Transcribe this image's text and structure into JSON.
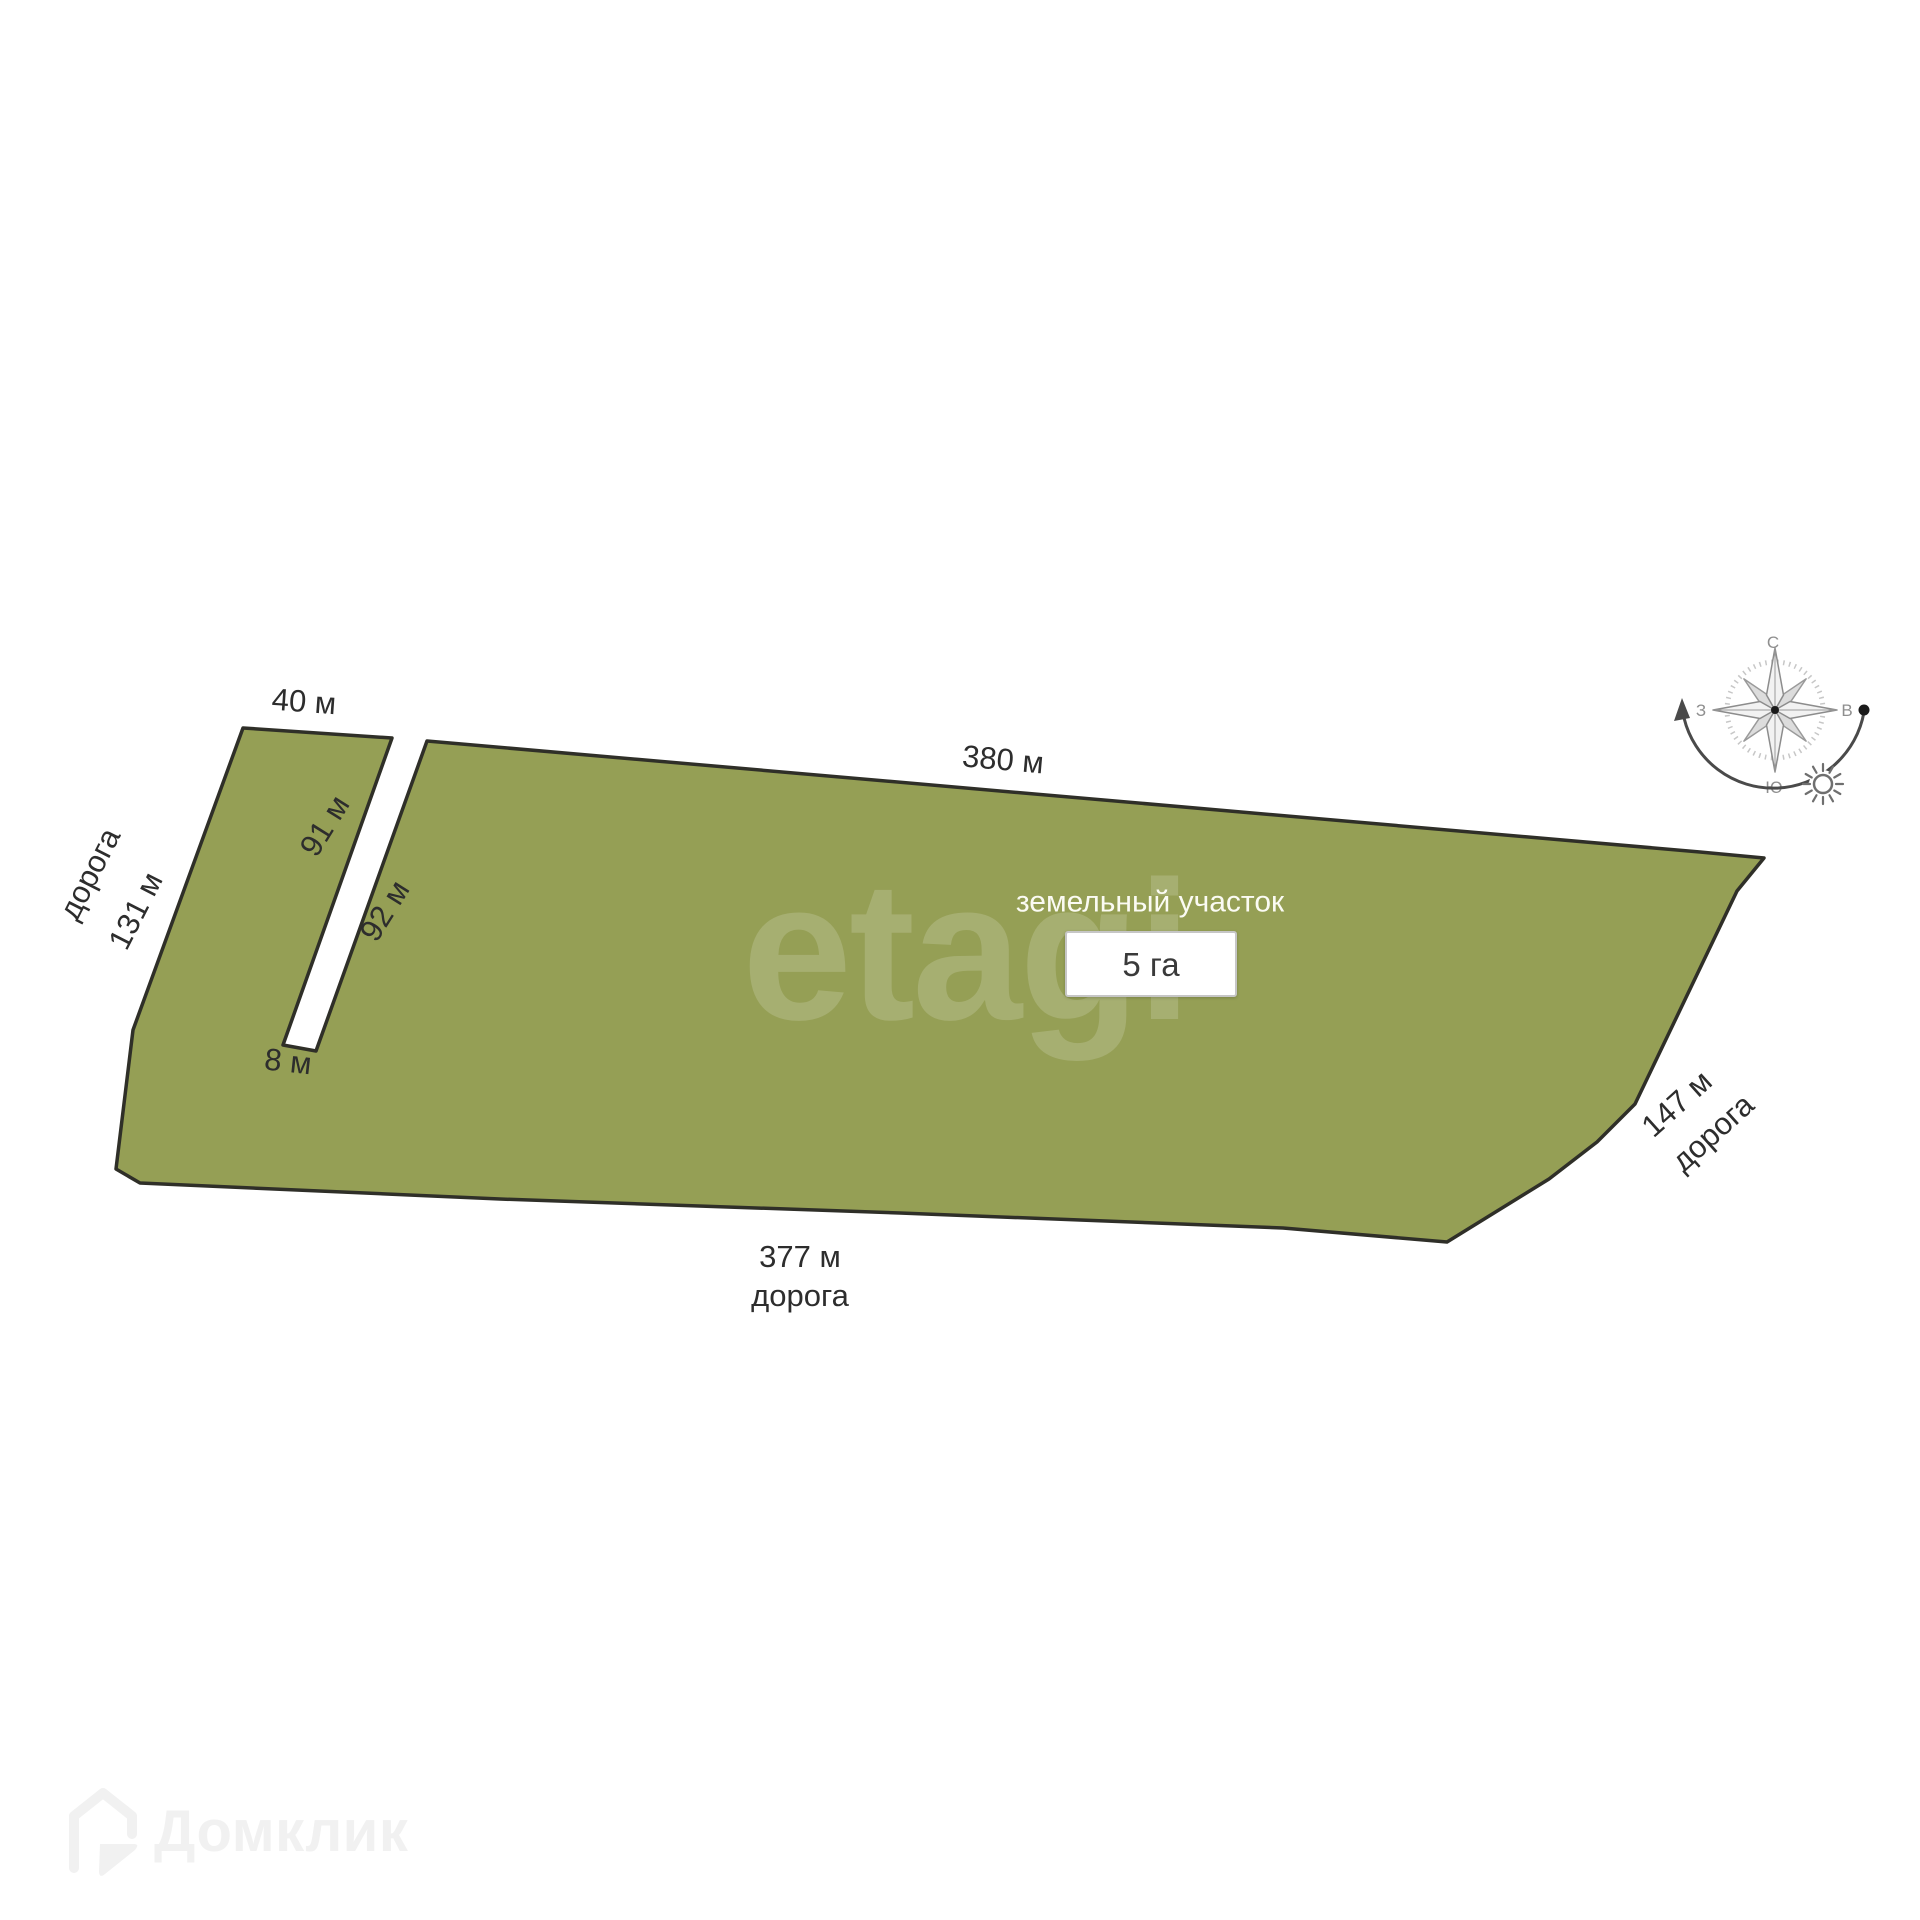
{
  "plot": {
    "title": "земельный участок",
    "area": "5 га"
  },
  "dimensions": {
    "top_small": "40 м",
    "top": "380 м",
    "left": "131 м",
    "notch_left": "91 м",
    "notch_right": "92 м",
    "notch_bottom": "8 м",
    "right": "147 м",
    "bottom": "377 м"
  },
  "roads": {
    "left": "дорога",
    "right": "дорога",
    "bottom": "дорога"
  },
  "compass": {
    "north": "С",
    "south": "Ю",
    "east": "В",
    "west": "З"
  },
  "watermarks": {
    "etagi": "etagi",
    "domclick": "Домклик"
  },
  "colors": {
    "plot_fill": "#959F55",
    "plot_border": "#2F2F28"
  }
}
